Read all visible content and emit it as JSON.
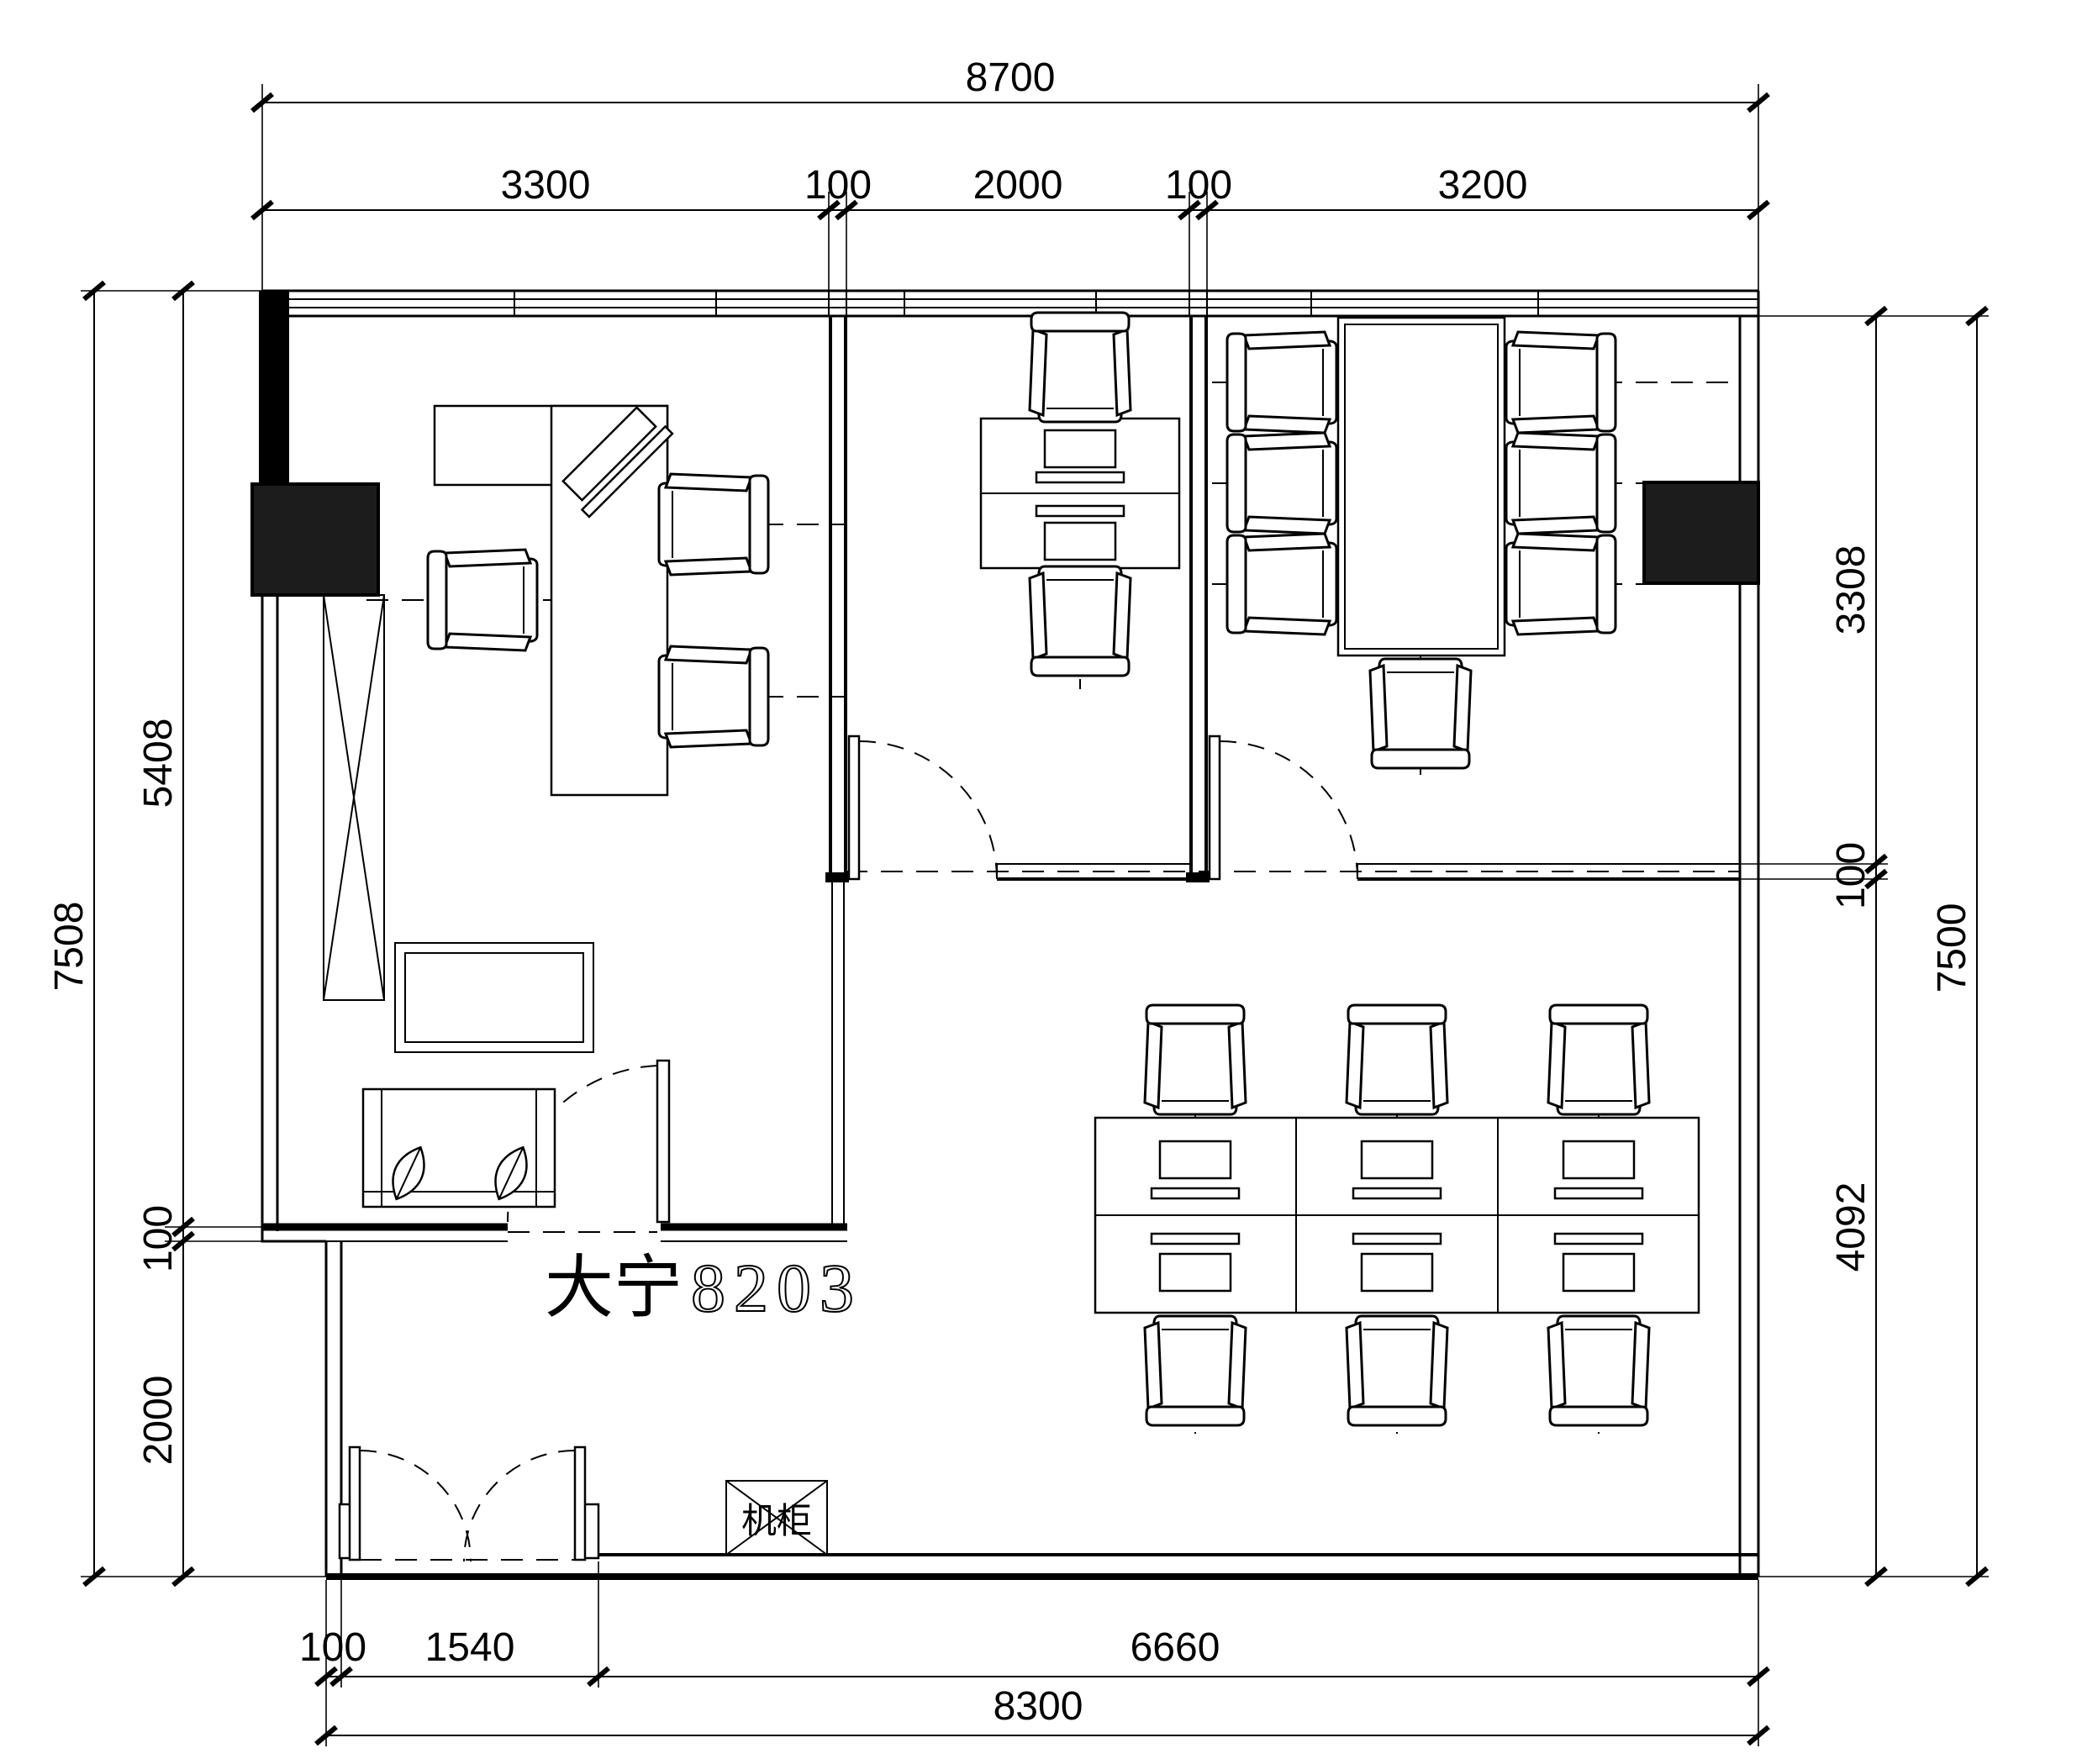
{
  "labels": {
    "room_name_cn": "大宁",
    "room_number": "8203",
    "rack": "机柜"
  },
  "dimensions": {
    "top": {
      "overall": "8700",
      "segments": [
        "3300",
        "100",
        "2000",
        "100",
        "3200"
      ]
    },
    "left": {
      "overall": "7508",
      "segments": [
        "5408",
        "100",
        "2000"
      ]
    },
    "right": {
      "overall": "7500",
      "segments": [
        "3308",
        "100",
        "4092"
      ]
    },
    "bottom": {
      "overall": "8300",
      "segments": [
        "100",
        "1540",
        "6660"
      ]
    }
  },
  "colors": {
    "line": "#000000",
    "background": "#ffffff",
    "column_fill": "#1c1c1c"
  }
}
